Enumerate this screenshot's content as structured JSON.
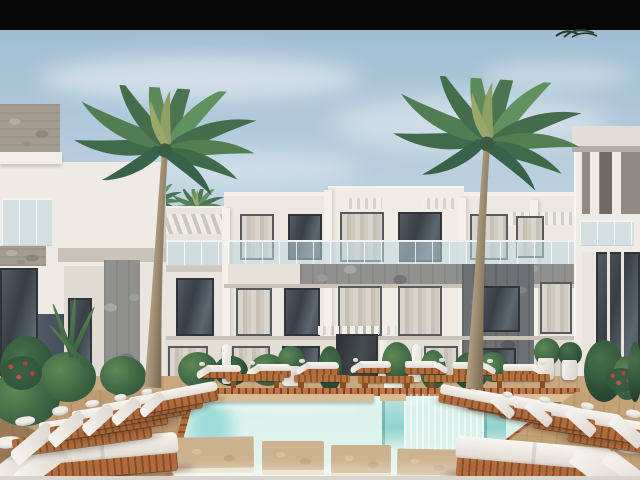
{
  "window": {
    "width": 640,
    "height": 480
  },
  "scene": {
    "kind": "architectural exterior render, photographic style, no on-screen text",
    "subject": "Modern three-story white resort apartment building with courtyard swimming pool, palm trees and sun loungers",
    "elements": {
      "letterbox_bar": "solid black strip across the top of the frame",
      "sky": "pale blue sky with thin soft clouds",
      "buildings": [
        "central three-story white block with glass balcony railings, stone-clad parapet and pergola slats",
        "left foreground wing with stone-capped balconies, dark slate panel and stone pillar",
        "right foreground wing with deep shadowed balcony recesses and tall dark windows"
      ],
      "palm_trees": {
        "large_foreground": 2,
        "small_background": 2,
        "tiny_silhouette_top_right": 1
      },
      "pool": "turquoise pool with four wooden stepping platforms, submerged bench walls and twin cascade steps",
      "decks": "warm wooden decks on both sides plus a far walkway behind the pool coping",
      "sun_loungers": {
        "left_group": 6,
        "right_group": 6,
        "far_row": 7,
        "wood_benches": 6
      },
      "plants": "tropical shrubs, red flowering bushes, white planter pots and two closed white parasols"
    },
    "palette": {
      "letterbox": "#060606",
      "sky_top": "#9cbacf",
      "sky_horizon": "#dde9ef",
      "building_white": "#efebe4",
      "building_shadow": "#d9d3cb",
      "stone_gray": "#90918f",
      "stone_dark": "#6e7173",
      "slate_panel": "#4a5460",
      "window_glass": "#3e454c",
      "curtain": "#d6d1c8",
      "glass_railing": "#bed6df",
      "palm_green": "#4a7550",
      "trunk_brown": "#93825f",
      "pool_turquoise": "#86d2d6",
      "pool_pale": "#e6f5ee",
      "deck_tan": "#c9a87f",
      "lounger_wood": "#b06c3e",
      "cushion_white": "#f4f2ed",
      "flower_red": "#b84343"
    }
  }
}
